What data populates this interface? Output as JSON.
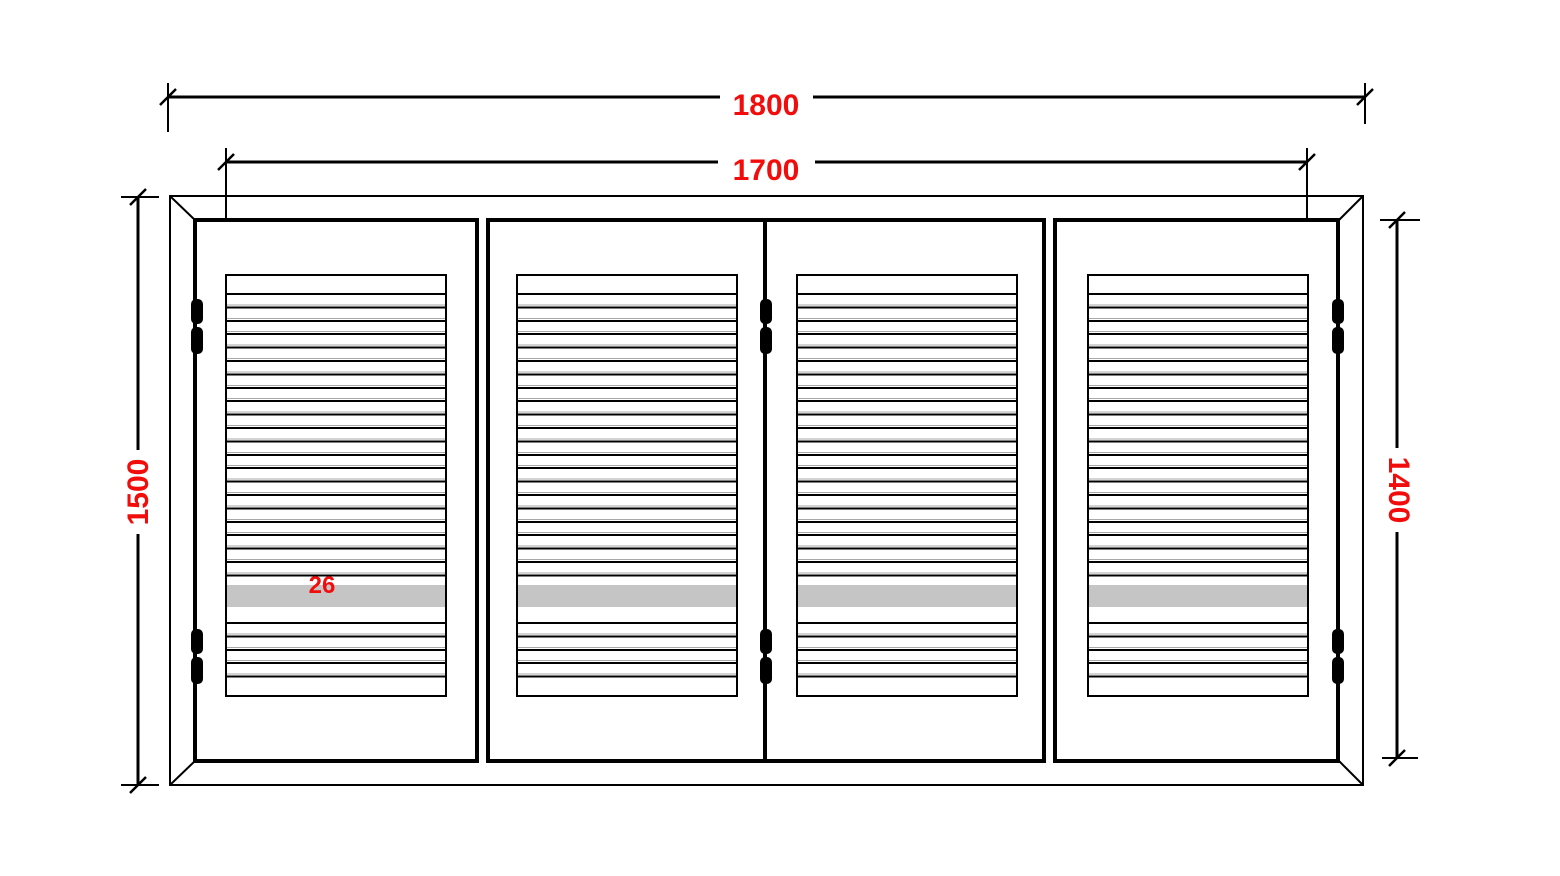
{
  "drawing": {
    "subject": "four-leaf louvered bifold shutter elevation",
    "panel_count": 4,
    "hinge_count": 6
  },
  "dimensions": {
    "overall_width": "1800",
    "leaf_span_width": "1700",
    "overall_height": "1500",
    "leaf_height": "1400",
    "slat_thickness": "26"
  },
  "colors": {
    "line": "#000000",
    "dimension_text": "#f20d0d",
    "highlight_band": "#c5c5c5",
    "slat_hairline": "#a8a8a8"
  }
}
